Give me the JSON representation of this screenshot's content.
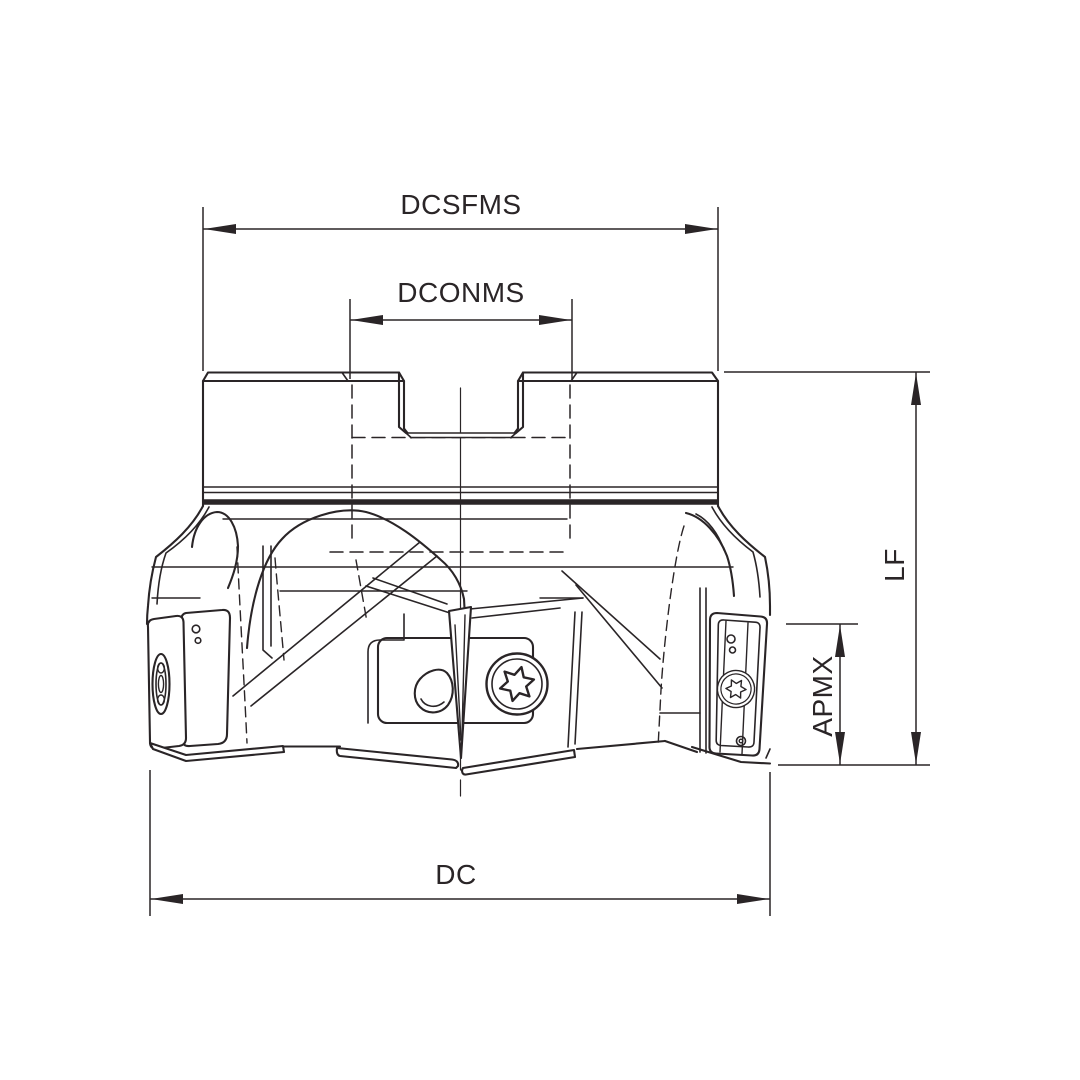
{
  "drawing": {
    "kind": "technical-dimension-drawing",
    "subject": "indexable face milling cutter, side view",
    "dimension_labels": {
      "dcsfms": "DCSFMS",
      "dconms": "DCONMS",
      "lf": "LF",
      "apmx": "APMX",
      "dc": "DC"
    },
    "colors": {
      "ink": "#2a2527",
      "background": "#ffffff"
    }
  }
}
